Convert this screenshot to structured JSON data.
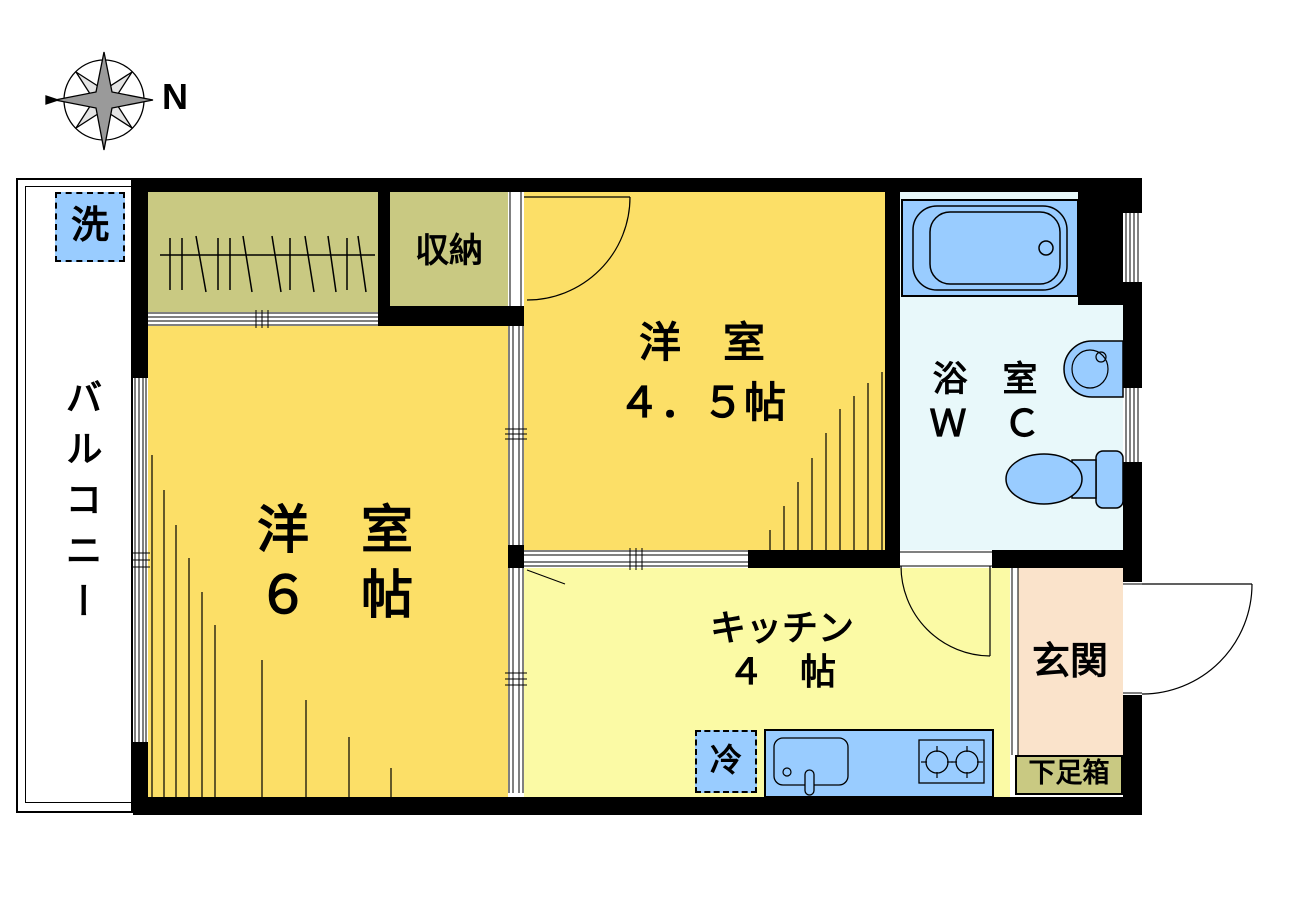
{
  "compass": {
    "label": "N"
  },
  "balcony": {
    "label": "バルコニー",
    "washer_label": "洗"
  },
  "rooms": {
    "western6": {
      "name": "洋　室",
      "size": "６　帖"
    },
    "western45": {
      "name": "洋　室",
      "size": "４．５帖"
    },
    "kitchen": {
      "name": "キッチン",
      "size": "４　帖",
      "fridge_label": "冷"
    },
    "bath": {
      "name": "浴　室",
      "wc_label": "Ｗ　Ｃ"
    },
    "storage": {
      "name": "収納"
    },
    "entrance": {
      "name": "玄関",
      "shoebox_label": "下足箱"
    }
  },
  "colors": {
    "wall": "#000000",
    "room_yellow": "#FCDF67",
    "kitchen_yellow": "#FBFAA5",
    "closet_olive": "#C9C982",
    "bath_floor": "#E8F8FA",
    "fixture_blue": "#99CCFF",
    "entrance_peach": "#FAE3CB",
    "compass_dark": "#9A9A9A",
    "compass_light": "#E4E4E4"
  }
}
